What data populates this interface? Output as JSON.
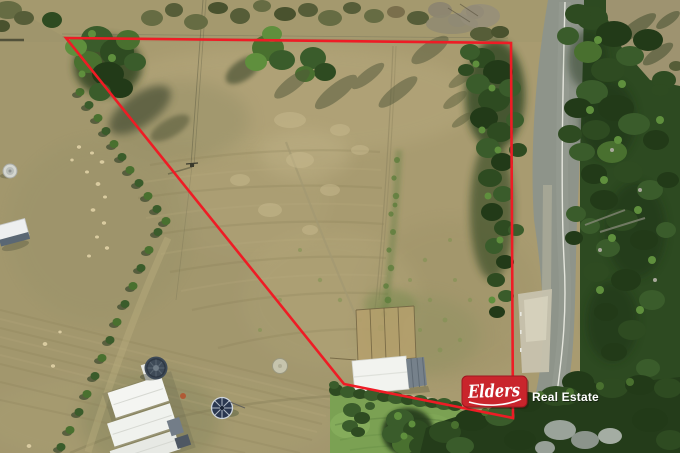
{
  "watermark": {
    "brand": "Elders",
    "suffix": "Real Estate",
    "badge_color": "#c9252c",
    "badge_border": "#9e1620",
    "text_color": "#ffffff"
  },
  "boundary": {
    "color": "#ee1c25",
    "stroke_width": "2.6",
    "points": "66,38 511,43 513,418 344,384"
  },
  "palette": {
    "grass_base": "#a89b70",
    "grass_light": "#c0b288",
    "grass_olive": "#8e8a60",
    "lawn_green": "#7ba153",
    "tree_dark": "#223a18",
    "tree_mid": "#2e4b21",
    "tree_light": "#49702f",
    "road_gray": "#8e948a",
    "road_centerline": "#f2f2ea",
    "gravel": "#c7c2ae",
    "roof_white": "#f3f4f1",
    "tank_gray": "#3e4a57"
  }
}
